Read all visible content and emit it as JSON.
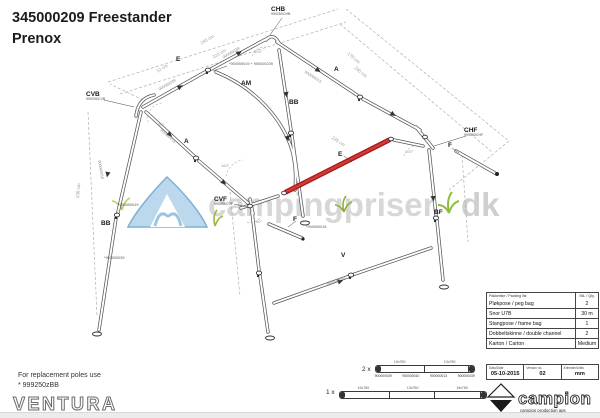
{
  "title": {
    "line1": "345000209 Freestander",
    "line2": "Prenox"
  },
  "note": {
    "line1": "For replacement poles use",
    "line2": "* 999250zBB"
  },
  "brand": {
    "ventura": "VENTURA"
  },
  "campion": {
    "name": "campion",
    "tagline": "campion production aps"
  },
  "watermark": {
    "part1": "campingpriser",
    "part2": "dk"
  },
  "packing_table": {
    "header_left": "Pakkeliste / Packing list",
    "header_right": "Stk. / Qty.",
    "rows": [
      {
        "label": "Pløkpose / peg bag",
        "qty": "2"
      },
      {
        "label": "Snor U7B",
        "qty": "30 m"
      },
      {
        "label": "Stangpose / frame bag",
        "qty": "1"
      },
      {
        "label": "Dobbeltskinne / double channel",
        "qty": "2"
      },
      {
        "label": "Karton / Carton",
        "qty": "Medium"
      }
    ],
    "meta": [
      {
        "label": "Dato/Date",
        "value": "05-10-2015"
      },
      {
        "label": "Version no.",
        "value": "02"
      },
      {
        "label": "Enheder/Units",
        "value": "mm"
      }
    ]
  },
  "spare_poles": [
    {
      "count": "2 x",
      "dims": [
        "19x750",
        "13x750"
      ],
      "parts": [
        "900000039",
        "900000010",
        "900000013",
        "900000039"
      ],
      "segments": 2
    },
    {
      "count": "1 x",
      "dims": [
        "19x750",
        "13x750",
        "19x750"
      ],
      "parts": [],
      "segments": 3
    }
  ],
  "colors": {
    "red_pole": "#c52025",
    "line": "#565656",
    "watermark_text": "#d7d7d7",
    "tent_blue": "#bcd8ec",
    "grass_green": "#9cb83c"
  },
  "diagram": {
    "labels": [
      {
        "text": "CHB",
        "sub": "999250CHB",
        "x": 271,
        "y": 6
      },
      {
        "text": "CVB",
        "sub": "999250CVB",
        "x": 86,
        "y": 91
      },
      {
        "text": "CHF",
        "sub": "999250CHF",
        "x": 464,
        "y": 127
      },
      {
        "text": "CVF",
        "sub": "999250CVF",
        "x": 214,
        "y": 196
      },
      {
        "text": "E",
        "x": 176,
        "y": 56
      },
      {
        "text": "E",
        "x": 338,
        "y": 151
      },
      {
        "text": "A",
        "x": 334,
        "y": 66
      },
      {
        "text": "A",
        "x": 184,
        "y": 138
      },
      {
        "text": "AM",
        "x": 241,
        "y": 80
      },
      {
        "text": "BB",
        "x": 289,
        "y": 99
      },
      {
        "text": "BB",
        "x": 101,
        "y": 220
      },
      {
        "text": "BF",
        "x": 434,
        "y": 209
      },
      {
        "text": "V",
        "x": 341,
        "y": 252
      },
      {
        "text": "F",
        "x": 293,
        "y": 216
      },
      {
        "text": "F",
        "x": 448,
        "y": 142
      },
      {
        "text": "*900000019 + 900000239",
        "x": 229,
        "y": 62,
        "size": 3.8,
        "weight": 400,
        "color": "#555555"
      },
      {
        "text": "*900000019",
        "x": 118,
        "y": 203,
        "size": 3.8,
        "weight": 400,
        "color": "#555555"
      },
      {
        "text": "*900000039",
        "x": 104,
        "y": 256,
        "size": 3.8,
        "weight": 400,
        "color": "#555555"
      },
      {
        "text": "*900000016",
        "x": 306,
        "y": 225,
        "size": 3.8,
        "weight": 400,
        "color": "#555555"
      },
      {
        "text": "245 cm",
        "x": 200,
        "y": 42,
        "size": 4.5,
        "weight": 400,
        "color": "#9a9a9a",
        "rot": -30
      },
      {
        "text": "223 cm",
        "x": 212,
        "y": 56,
        "size": 4.5,
        "weight": 400,
        "color": "#9a9a9a",
        "rot": -30
      },
      {
        "text": "12 cm",
        "x": 156,
        "y": 70,
        "size": 4.5,
        "weight": 400,
        "color": "#9a9a9a",
        "rot": -30
      },
      {
        "text": "170 cm",
        "x": 349,
        "y": 52,
        "size": 4.5,
        "weight": 400,
        "color": "#9a9a9a",
        "rot": 40
      },
      {
        "text": "245 cm",
        "x": 356,
        "y": 66,
        "size": 4.5,
        "weight": 400,
        "color": "#9a9a9a",
        "rot": 40
      },
      {
        "text": "230 cm",
        "x": 76,
        "y": 198,
        "size": 4.5,
        "weight": 400,
        "color": "#9a9a9a",
        "rot": -85
      },
      {
        "text": "225 cm",
        "x": 333,
        "y": 136,
        "size": 4.5,
        "weight": 400,
        "color": "#9a9a9a",
        "rot": 33
      },
      {
        "text": "90°",
        "x": 158,
        "y": 123,
        "size": 4,
        "weight": 400,
        "color": "#9a9a9a"
      },
      {
        "text": "104°",
        "x": 254,
        "y": 50,
        "size": 4,
        "weight": 400,
        "color": "#9a9a9a"
      },
      {
        "text": "163°",
        "x": 221,
        "y": 164,
        "size": 4,
        "weight": 400,
        "color": "#9a9a9a"
      },
      {
        "text": "90°",
        "x": 256,
        "y": 220,
        "size": 4,
        "weight": 400,
        "color": "#9a9a9a"
      },
      {
        "text": "100°",
        "x": 405,
        "y": 150,
        "size": 4,
        "weight": 400,
        "color": "#9a9a9a"
      },
      {
        "text": "900000239",
        "x": 158,
        "y": 88,
        "size": 3.8,
        "weight": 400,
        "color": "#8a8a8a",
        "rot": -30
      },
      {
        "text": "900000239",
        "x": 222,
        "y": 56,
        "size": 3.8,
        "weight": 400,
        "color": "#8a8a8a",
        "rot": -30
      },
      {
        "text": "900000213",
        "x": 162,
        "y": 128,
        "size": 3.8,
        "weight": 400,
        "color": "#8a8a8a",
        "rot": 42
      },
      {
        "text": "900000213",
        "x": 306,
        "y": 70,
        "size": 3.8,
        "weight": 400,
        "color": "#8a8a8a",
        "rot": 33
      },
      {
        "text": "900000019",
        "x": 101,
        "y": 160,
        "size": 3.8,
        "weight": 400,
        "color": "#8a8a8a",
        "rot": 80
      },
      {
        "text": "900000040",
        "x": 326,
        "y": 282,
        "size": 3.8,
        "weight": 400,
        "color": "#8a8a8a",
        "rot": -19
      }
    ]
  }
}
